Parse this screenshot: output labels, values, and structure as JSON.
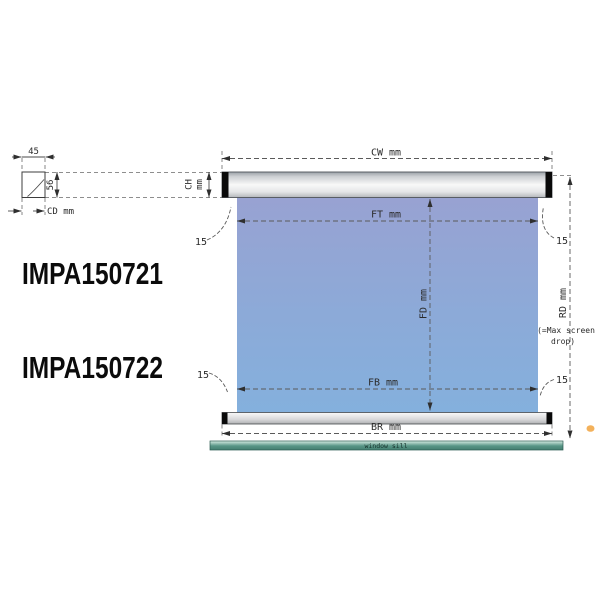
{
  "drawing": {
    "product_codes": {
      "code1": "IMPA150721",
      "code2": "IMPA150722"
    },
    "dimensions": {
      "cw": "CW mm",
      "ch_word": "CH",
      "ch_unit": "mm",
      "cd": "CD mm",
      "ft": "FT mm",
      "fd": "FD mm",
      "fb": "FB mm",
      "br": "BR mm",
      "rd": "RD mm",
      "rd_note_line1": "(=Max screen",
      "rd_note_line2": "drop)",
      "case_depth_value": "45",
      "case_height_value": "56",
      "edge_gap_value": "15"
    },
    "labels": {
      "window_sill": "window sill"
    },
    "colors": {
      "screen_top": "#98a2d2",
      "screen_bottom": "#84b0dd",
      "casing_light": "#f8f8f8",
      "casing_dark": "#9aa0a6",
      "end_cap": "#0a0a0a",
      "sill_teal": "#579585",
      "dim_line": "#5a5a5a",
      "accent_orange": "#f1a33e"
    }
  }
}
